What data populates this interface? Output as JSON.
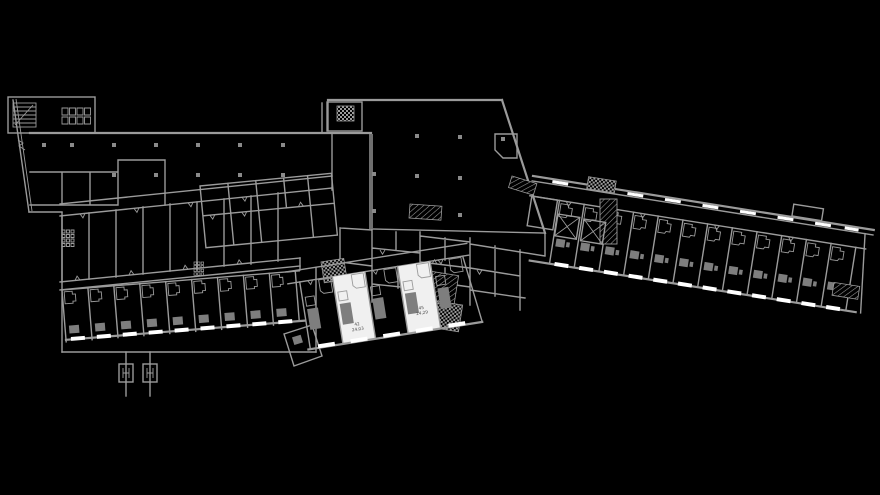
{
  "drawing": {
    "type": "architectural floor plan (CAD)",
    "description": "Black-background CAD floor plan of a building with a large top hall, service core, a straight lower-left hotel-room wing and a long diagonal right wing of repeated guest rooms; two rooms are highlighted white with room number and area labels.",
    "background": "#000000",
    "highlighted_rooms": [
      {
        "number": "42",
        "area_m2": "24,03"
      },
      {
        "number": "45",
        "area_m2": "24,29"
      }
    ]
  },
  "colors": {
    "background": "#000000",
    "wall": "#9b9b9b",
    "wall_dark": "#6f6f6f",
    "furniture": "#7e7e7e",
    "column": "#8a8a8a",
    "window": "#ffffff",
    "room_highlight": "#f0f0f0",
    "label_text": "#4a4a4a"
  }
}
